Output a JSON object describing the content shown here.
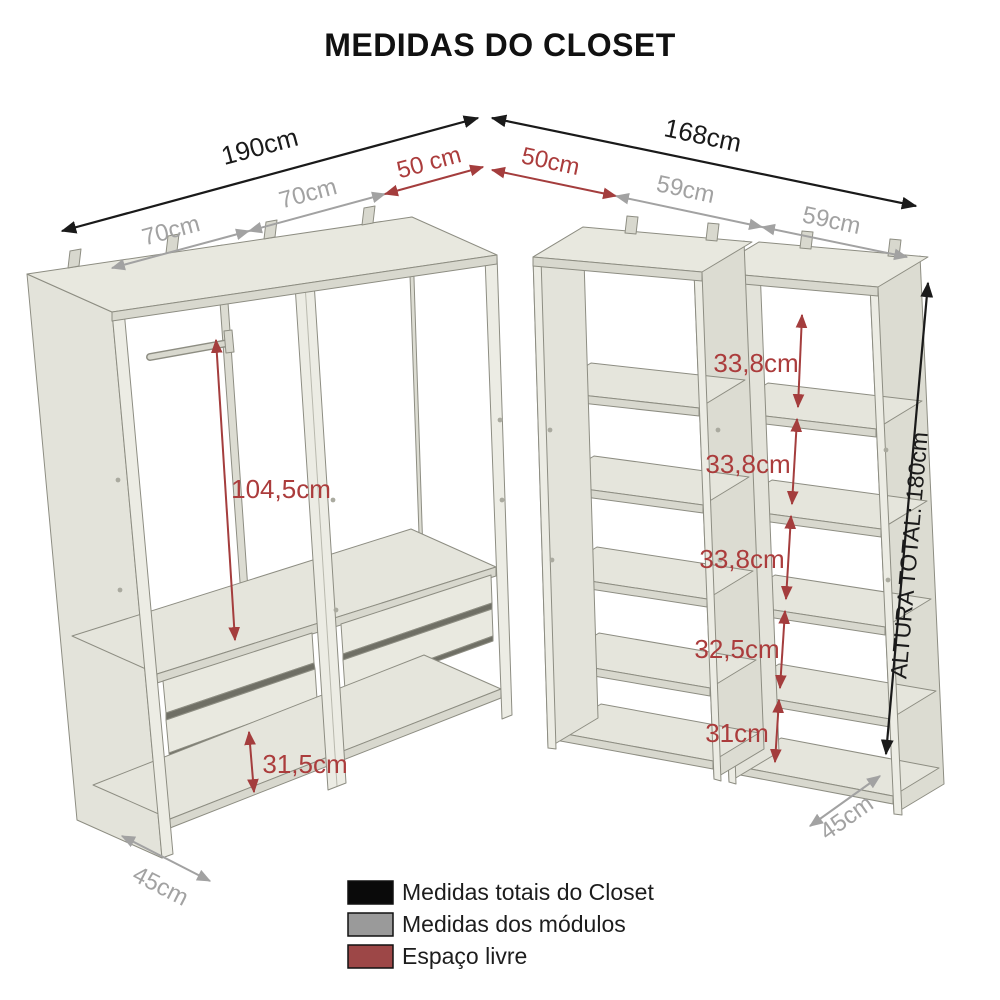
{
  "title": "MEDIDAS DO CLOSET",
  "diagram": {
    "top_left": {
      "total": "190cm",
      "segments": [
        "70cm",
        "70cm"
      ],
      "free": "50 cm"
    },
    "top_right": {
      "total": "168cm",
      "free": "50cm",
      "segments": [
        "59cm",
        "59cm"
      ]
    },
    "left_unit": {
      "hanging_height": "104,5cm",
      "bottom_gap": "31,5cm",
      "depth": "45cm"
    },
    "right_unit": {
      "shelf_gaps": [
        "33,8cm",
        "33,8cm",
        "33,8cm",
        "32,5cm",
        "31cm"
      ],
      "depth": "45cm",
      "total_height_label": "ALTURA TOTAL: 180cm"
    }
  },
  "legend": {
    "items": [
      {
        "label": "Medidas totais do Closet",
        "color": "#0a0a0a"
      },
      {
        "label": "Medidas dos módulos",
        "color": "#9a9a9a"
      },
      {
        "label": "Espaço livre",
        "color": "#9d4747"
      }
    ]
  },
  "colors": {
    "total_measure": "#1a1a1a",
    "module_measure": "#a2a2a2",
    "free_space_measure": "#a43d3d",
    "furniture": "#e8e8df"
  }
}
